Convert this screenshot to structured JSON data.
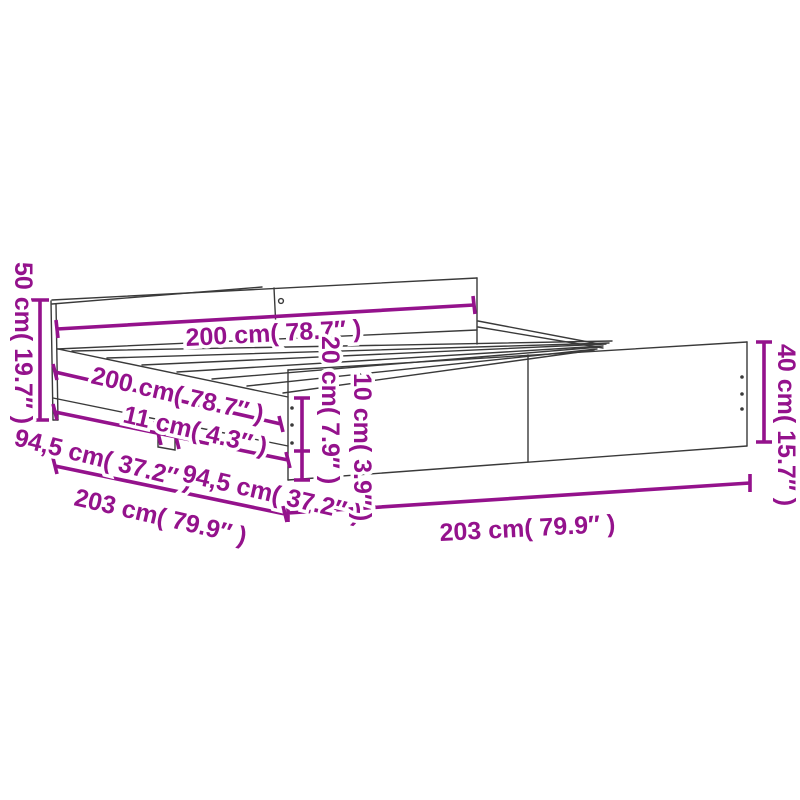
{
  "diagram": {
    "subject": "bed-frame-with-headboard-and-footboard-dimension-drawing",
    "accent_color": "#94128C",
    "line_color": "#3A3A3A",
    "background_color": "#FFFFFF",
    "labels": {
      "headboard_height": "50 cm( 19.7″ )",
      "headboard_width": "200 cm( 78.7″ )",
      "bed_length": "200 cm( 78.7″ )",
      "center_leg_width": "11 cm( 4.3″ )",
      "side_section_front": "94,5 cm( 37.2″ )",
      "side_section_back": "94,5 cm( 37.2″ )",
      "side_overall_length": "203 cm( 79.9″ )",
      "side_rail_height": "20 cm( 7.9″ )",
      "ground_clearance": "10 cm( 3.9″ )",
      "front_overall_width": "203 cm( 79.9″ )",
      "footboard_height": "40 cm( 15.7″ )"
    }
  }
}
